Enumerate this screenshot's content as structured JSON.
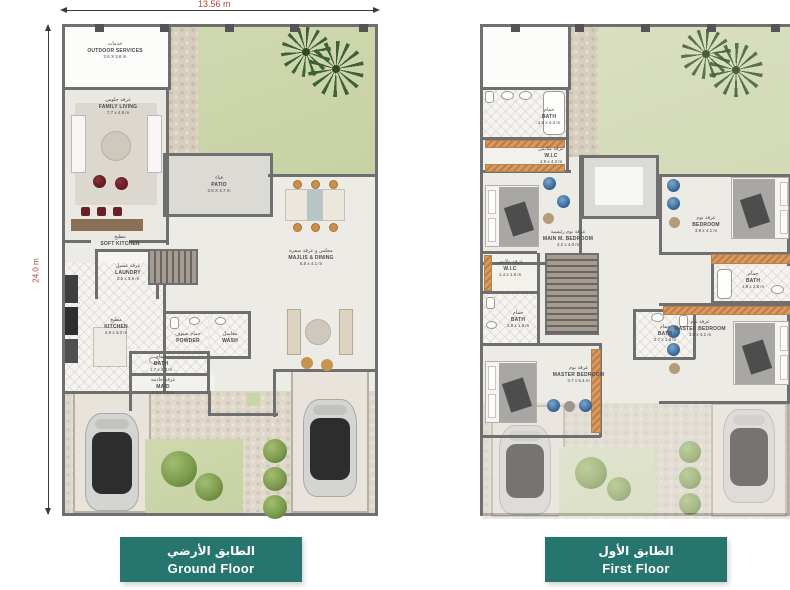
{
  "sheet": {
    "top_dimension": "13.56 m",
    "side_dimension": "24.0 m",
    "accent_teal": "#27756f",
    "dimension_red": "#b0413c",
    "wall_gray": "#6f6f6f",
    "lawn_green": "#cdd6ac"
  },
  "ground_floor": {
    "tag_ar": "الطابق الأرضي",
    "tag_en": "Ground Floor",
    "rooms": {
      "outdoor_services": {
        "ar": "خدمات",
        "en": "OUTDOOR SERVICES",
        "size": "2.6 X 3.6 m"
      },
      "family_living": {
        "ar": "غرفة جلوس",
        "en": "FAMILY LIVING",
        "size": "7.7 x 4.8 m"
      },
      "patio": {
        "ar": "فناء",
        "en": "PATIO",
        "size": "2.9 X 4.7 m"
      },
      "soft_kitchen": {
        "ar": "مطبخ",
        "en": "SOFT KITCHEN",
        "size": ""
      },
      "majlis_dining": {
        "ar": "مجلس و غرفة سفرة",
        "en": "MAJLIS & DINING",
        "size": "5.8 x 4.1 m"
      },
      "laundry": {
        "ar": "غرفة غسيل",
        "en": "LAUNDRY",
        "size": "2.5 x 3.8 m"
      },
      "kitchen": {
        "ar": "مطبخ",
        "en": "KITCHEN",
        "size": "4.9 x 3.0 m"
      },
      "powder": {
        "ar": "حمام ضيوف",
        "en": "POWDER",
        "size": ""
      },
      "wash": {
        "ar": "مغاسل",
        "en": "WASH",
        "size": ""
      },
      "bath": {
        "ar": "حمام",
        "en": "BATH",
        "size": "1.7 x 2.3 m"
      },
      "maid": {
        "ar": "غرفة خادمة",
        "en": "MAID",
        "size": "2.2 x 2.5 m"
      }
    }
  },
  "first_floor": {
    "tag_ar": "الطابق الأول",
    "tag_en": "First Floor",
    "rooms": {
      "bath_top": {
        "ar": "حمام",
        "en": "BATH",
        "size": "1.6 x 4.2 m"
      },
      "wic_top": {
        "ar": "غرفة ملابس",
        "en": "W.I.C",
        "size": "1.9 x 4.2 m"
      },
      "main_bedroom": {
        "ar": "غرفة نوم رئيسية",
        "en": "MAIN M. BEDROOM",
        "size": "4.2 x 4.0 m"
      },
      "bedroom": {
        "ar": "غرفة نوم",
        "en": "BEDROOM",
        "size": "3.9 x 4.1 m"
      },
      "bath_right": {
        "ar": "حمام",
        "en": "BATH",
        "size": "1.9 x 2.8 m"
      },
      "master_bedroom_right": {
        "ar": "غرفة نوم",
        "en": "MASTER BEDROOM",
        "size": "3.8 x 4.1 m"
      },
      "wic_left": {
        "ar": "غرفة ملابس",
        "en": "W.I.C",
        "size": "1.4 x 1.8 m"
      },
      "bath_left": {
        "ar": "حمام",
        "en": "BATH",
        "size": "2.8 x 1.8 m"
      },
      "bath_middle": {
        "ar": "حمام",
        "en": "BATH",
        "size": "2.7 x 1.8 m"
      },
      "master_bedroom_left": {
        "ar": "غرفة نوم",
        "en": "MASTER BEDROOM",
        "size": "3.7 x 5.4 m"
      }
    }
  }
}
